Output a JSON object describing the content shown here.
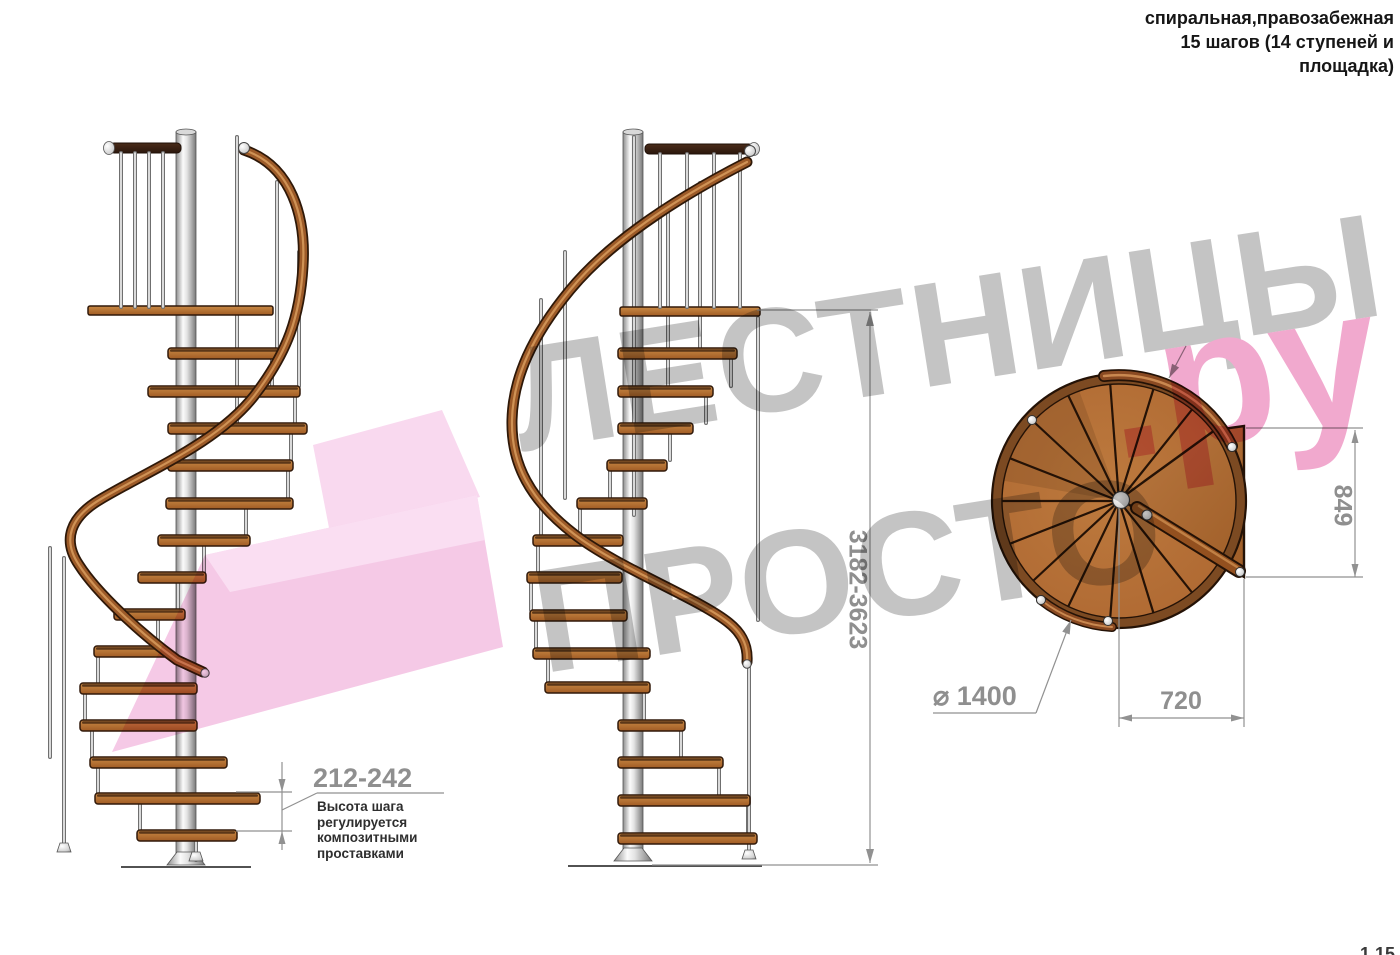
{
  "page": {
    "width": 1400,
    "height": 955,
    "background": "#ffffff"
  },
  "header": {
    "line1": "спиральная,правозабежная",
    "line2": "15 шагов (14 ступеней и",
    "line3": "площадка)"
  },
  "footer": {
    "page_number": "1.15"
  },
  "watermark": {
    "line1": "ЛЕСТНИЦЫ",
    "line2": "ПРОСТО",
    "suffix": ".ру",
    "gray_color": "#c4c4c4",
    "pink_color": "#f1a9ce",
    "arrow_pink_light": "#f9d9ef",
    "arrow_pink": "#f5c9e6"
  },
  "dimensions": {
    "step_height": {
      "value": "212-242",
      "notes": [
        "Высота шага",
        "регулируется",
        "композитными",
        "проставками"
      ]
    },
    "total_height": {
      "value": "3182-3623"
    },
    "platform_depth": {
      "value": "849"
    },
    "step_width": {
      "value": "720"
    },
    "diameter": {
      "value": "⌀ 1400"
    }
  },
  "colors": {
    "wood_light": "#c98a45",
    "wood_dark": "#a15c24",
    "wood_outline": "#30190a",
    "rail_brown": "#9c5a28",
    "pole_light": "#fbfbfb",
    "pole_dark": "#8f8f8f",
    "dimension_gray": "#919191",
    "dark_walnut": "#3b2316"
  },
  "figures": {
    "left_view": {
      "pole": [
        176,
        132,
        20,
        730
      ],
      "ground": [
        121,
        867,
        251
      ],
      "platform": [
        88,
        306,
        185
      ],
      "railing": {
        "bar": [
          110,
          143,
          71
        ],
        "cap_x": 109,
        "balusters": [
          121,
          135,
          149,
          163
        ],
        "by1": 153,
        "by2": 307
      },
      "post": [
        237,
        137,
        423
      ],
      "steps": [
        [
          168,
          348,
          112
        ],
        [
          148,
          386,
          152
        ],
        [
          168,
          423,
          139
        ],
        [
          168,
          460,
          125
        ],
        [
          166,
          498,
          127
        ],
        [
          158,
          535,
          92
        ],
        [
          138,
          572,
          68
        ],
        [
          114,
          609,
          71
        ],
        [
          94,
          646,
          74
        ],
        [
          80,
          683,
          117
        ],
        [
          80,
          720,
          117
        ],
        [
          90,
          757,
          137
        ],
        [
          95,
          793,
          165
        ],
        [
          137,
          830,
          100
        ]
      ],
      "balusters": [
        [
          121,
          153,
          307
        ],
        [
          135,
          153,
          307
        ],
        [
          149,
          153,
          307
        ],
        [
          163,
          153,
          307
        ],
        [
          237,
          137,
          423
        ],
        [
          277,
          182,
          348
        ],
        [
          299,
          252,
          386
        ],
        [
          272,
          352,
          386
        ],
        [
          295,
          390,
          423
        ],
        [
          291,
          427,
          460
        ],
        [
          288,
          464,
          498
        ],
        [
          246,
          501,
          535
        ],
        [
          204,
          538,
          572
        ],
        [
          178,
          575,
          609
        ],
        [
          158,
          612,
          646
        ],
        [
          98,
          650,
          683
        ],
        [
          85,
          687,
          720
        ],
        [
          92,
          724,
          757
        ],
        [
          98,
          760,
          793
        ],
        [
          140,
          797,
          830
        ],
        [
          196,
          834,
          860
        ],
        [
          50,
          548,
          757
        ],
        [
          64,
          558,
          843
        ]
      ],
      "rail": "M 244 150 C 292 166 306 218 303 266 C 300 316 288 352 254 396 C 218 442 150 470 101 499 C 70 517 62 540 79 565 C 97 593 140 633 177 660 L 203 672",
      "rail_start": [
        244,
        148
      ],
      "rail_end": [
        205,
        673
      ],
      "feet": [
        [
          64,
          843
        ],
        [
          196,
          852
        ]
      ]
    },
    "middle_view": {
      "pole": [
        623,
        132,
        20,
        726
      ],
      "ground": [
        568,
        866,
        762
      ],
      "platform": [
        620,
        307,
        140
      ],
      "railing": {
        "bar": [
          645,
          144,
          108
        ],
        "cap_x": 754,
        "balusters": [
          660,
          687,
          714,
          740
        ],
        "by1": 154,
        "by2": 307
      },
      "post": [
        634,
        137,
        515
      ],
      "steps": [
        [
          618,
          348,
          119
        ],
        [
          618,
          386,
          95
        ],
        [
          618,
          423,
          75
        ],
        [
          607,
          460,
          60
        ],
        [
          577,
          498,
          70
        ],
        [
          533,
          535,
          90
        ],
        [
          527,
          572,
          95
        ],
        [
          530,
          610,
          97
        ],
        [
          533,
          648,
          117
        ],
        [
          545,
          682,
          105
        ],
        [
          618,
          720,
          67
        ],
        [
          618,
          757,
          105
        ],
        [
          618,
          795,
          132
        ],
        [
          618,
          833,
          139
        ]
      ],
      "balusters": [
        [
          660,
          154,
          307
        ],
        [
          687,
          154,
          307
        ],
        [
          714,
          154,
          307
        ],
        [
          740,
          154,
          307
        ],
        [
          634,
          137,
          515
        ],
        [
          700,
          183,
          348
        ],
        [
          668,
          214,
          386
        ],
        [
          731,
          352,
          386
        ],
        [
          706,
          390,
          423
        ],
        [
          670,
          427,
          460
        ],
        [
          610,
          464,
          498
        ],
        [
          580,
          501,
          535
        ],
        [
          538,
          539,
          572
        ],
        [
          531,
          576,
          610
        ],
        [
          536,
          613,
          648
        ],
        [
          548,
          651,
          682
        ],
        [
          644,
          686,
          720
        ],
        [
          681,
          724,
          757
        ],
        [
          719,
          761,
          795
        ],
        [
          748,
          798,
          833
        ],
        [
          749,
          668,
          856
        ],
        [
          758,
          318,
          620
        ],
        [
          541,
          300,
          535
        ],
        [
          565,
          252,
          498
        ]
      ],
      "rail": "M 747 162 C 700 186 618 232 570 290 C 532 336 513 378 512 420 C 511 464 530 500 574 534 C 618 568 700 599 729 623 C 744 635 748 648 747 662",
      "rail_start": [
        750,
        151
      ],
      "rail_end": [
        747,
        664
      ],
      "feet": [
        [
          749,
          850
        ]
      ]
    },
    "plan_view": {
      "cx": 1119,
      "cy": 501,
      "r_outer": 127,
      "r_ring": 122,
      "r_inner": 117,
      "radial_angles": [
        -51.4,
        -72.9,
        -94.3,
        -115.7,
        -137.1,
        -158.6,
        180,
        158.6,
        137.1,
        115.7,
        94.3,
        72.9,
        51.4
      ],
      "platform": [
        [
          1120,
          499
        ],
        [
          1215,
          430
        ],
        [
          1244,
          426
        ],
        [
          1244,
          577
        ]
      ],
      "silver_dots": [
        [
          1032,
          420
        ],
        [
          1108,
          621
        ],
        [
          1041,
          600
        ],
        [
          1232,
          447
        ]
      ],
      "bar": [
        1137,
        508,
        1239,
        571
      ],
      "hub": [
        1121,
        500
      ]
    }
  }
}
